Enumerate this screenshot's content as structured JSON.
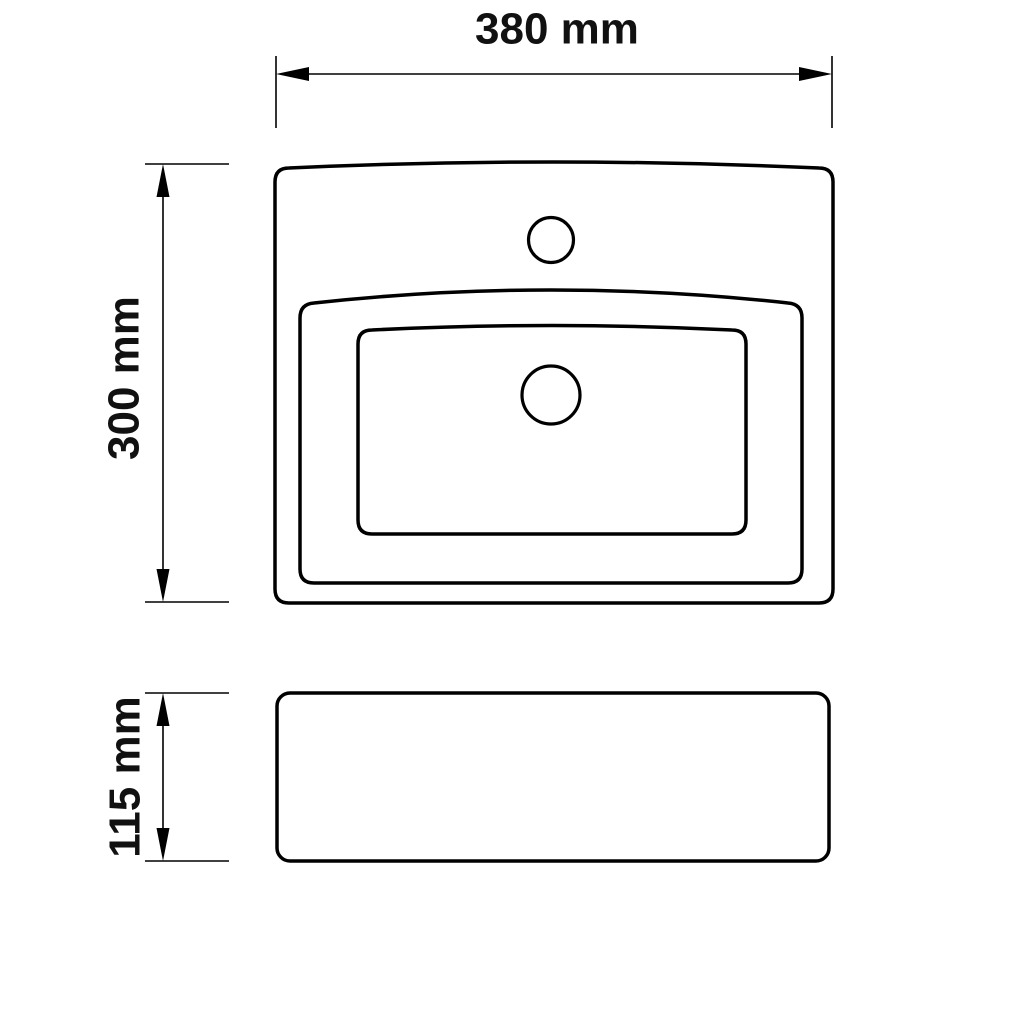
{
  "diagram": {
    "type": "technical-drawing",
    "background_color": "#ffffff",
    "line_color": "#000000",
    "labels": {
      "width": "380 mm",
      "depth": "300 mm",
      "height": "115 mm"
    },
    "values": {
      "width_mm": 380,
      "depth_mm": 300,
      "height_mm": 115,
      "unit": "mm"
    }
  }
}
